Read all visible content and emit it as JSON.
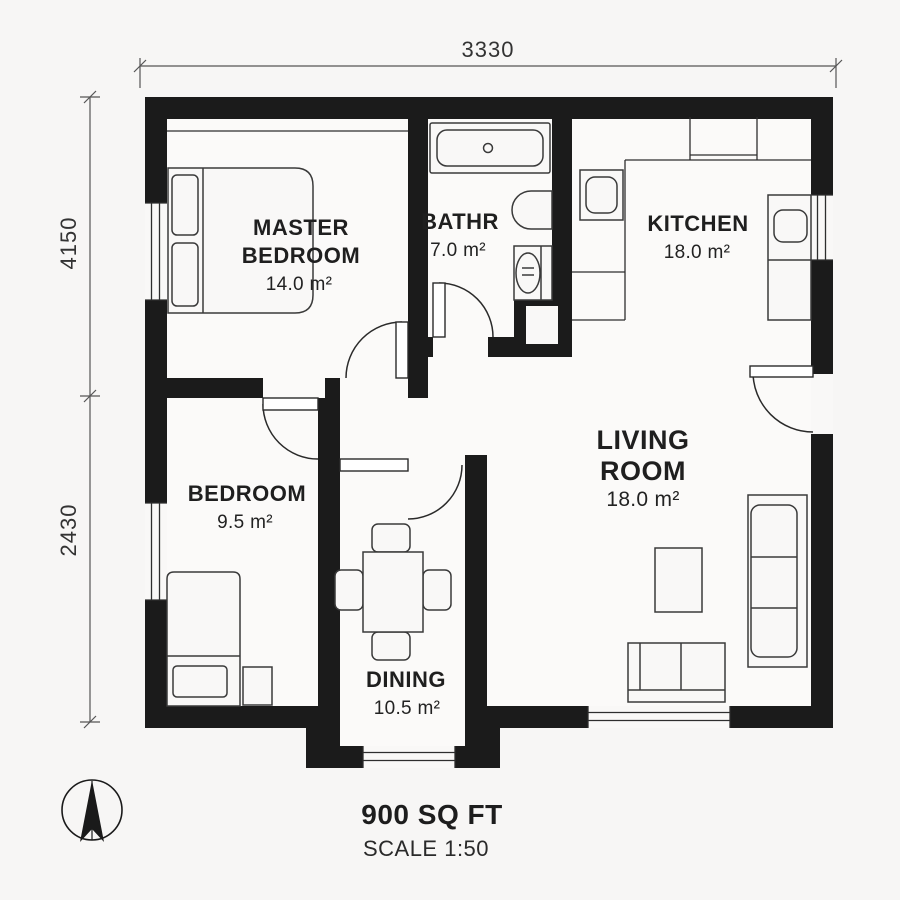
{
  "plan": {
    "dimensions": {
      "width_top": "3330",
      "height_upper_left": "4150",
      "height_lower_left": "2430"
    },
    "rooms": {
      "master_bedroom": {
        "line1": "MASTER",
        "line2": "BEDROOM",
        "area": "14.0 m²"
      },
      "bathroom": {
        "label": "BATHR",
        "area": "7.0 m²"
      },
      "kitchen": {
        "label": "KITCHEN",
        "area": "18.0 m²"
      },
      "bedroom": {
        "label": "BEDROOM",
        "area": "9.5 m²"
      },
      "living_room": {
        "line1": "LIVING",
        "line2": "ROOM",
        "area": "18.0 m²"
      },
      "dining": {
        "label": "DINING",
        "area": "10.5 m²"
      }
    },
    "footer": {
      "area_label": "900 SQ FT",
      "scale_label": "SCALE 1:50"
    },
    "icons": {
      "compass": "north-arrow"
    },
    "colors": {
      "wall": "#1b1b1b",
      "line": "#3a3a3a",
      "dimension": "#555555",
      "background": "#f7f6f5"
    }
  }
}
